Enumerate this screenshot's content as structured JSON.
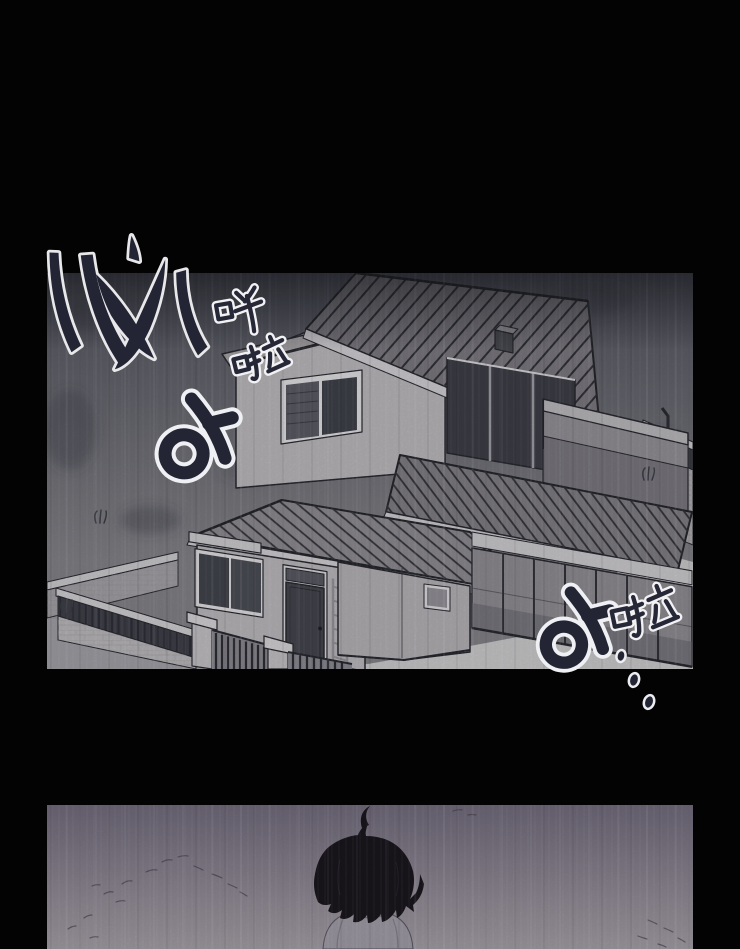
{
  "page": {
    "kind": "manga page",
    "bg": "#030304",
    "width": 740,
    "height": 949
  },
  "colors": {
    "sky_top": "#4e505a",
    "sky_bottom": "#7e7d82",
    "ground": "#c4c3c5",
    "ink_line": "#26272e",
    "sfx_fill": "#232534",
    "sfx_outline": "#eef0f3",
    "roof_fill": "#76747a",
    "wall_fill": "#b4b1b5",
    "glass_dark": "#3b3c44",
    "p2_top": "#6b6575",
    "p2_bottom": "#9b959c",
    "hair": "#18151c",
    "hoodie": "#98949e",
    "skin": "#b7abab"
  },
  "panel1": {
    "alt": "Two-story house with hatched roofs behind a walled yard in pouring rain"
  },
  "panel2": {
    "alt": "Boy with shaggy dark hair standing in the rain, head bowed"
  },
  "sfx": {
    "brush": {
      "alt": "heavy rain brush-stroke sound effect"
    },
    "hua": {
      "text": "哗"
    },
    "la_top": {
      "text": "啦"
    },
    "ah_left": {
      "text": "아"
    },
    "ah_right": {
      "text": "아"
    },
    "la_right": {
      "text": "啦"
    },
    "drips": {
      "alt": "dripping dots trail"
    }
  }
}
